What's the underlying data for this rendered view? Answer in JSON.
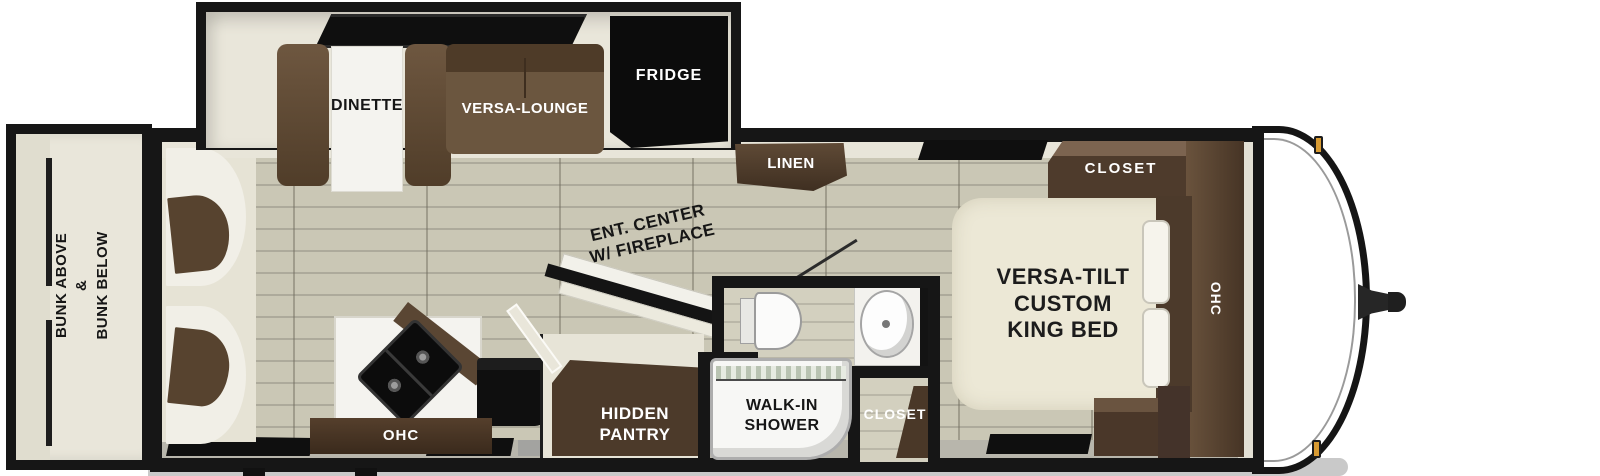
{
  "floorplan": {
    "rooms": {
      "bunk_area": "BUNK ABOVE\n&\nBUNK BELOW",
      "dinette": "DINETTE",
      "versa_lounge": "VERSA-LOUNGE",
      "fridge": "FRIDGE",
      "linen": "LINEN",
      "ent_center": "ENT. CENTER\nW/ FIREPLACE",
      "hidden_pantry": "HIDDEN\nPANTRY",
      "walk_in_shower": "WALK-IN\nSHOWER",
      "bath_closet": "CLOSET",
      "kitchen_ohc": "OHC",
      "bedroom_closet": "CLOSET",
      "bedroom_ohc": "OHC",
      "king_bed": "VERSA-TILT\nCUSTOM\nKING BED"
    },
    "colors": {
      "wall": "#161616",
      "floor_plank": "#c9c6b4",
      "cabinet_brown": "#5a4532",
      "cabinet_dark": "#3f2f21",
      "appliance_black": "#0d0d0d",
      "interior_cream": "#e9e6da",
      "bed_cream": "#ece8d6",
      "pantry_floor": "#4c3a2a",
      "marker_amber": "#d89b33",
      "ground_shadow": "#c8c8c8"
    }
  }
}
